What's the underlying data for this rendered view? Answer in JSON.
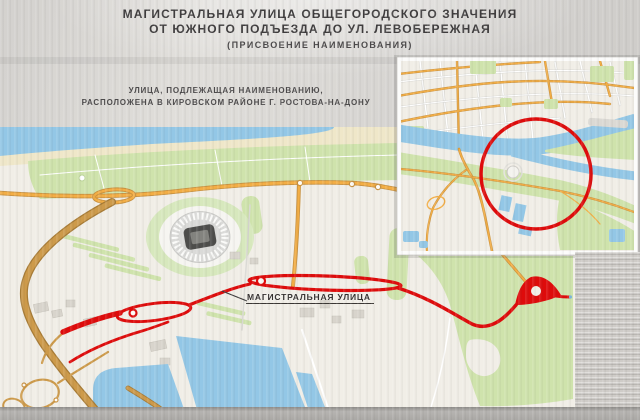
{
  "slide": {
    "title_line1": "МАГИСТРАЛЬНАЯ УЛИЦА ОБЩЕГОРОДСКОГО ЗНАЧЕНИЯ",
    "title_line2": "ОТ ЮЖНОГО ПОДЪЕЗДА ДО УЛ. ЛЕВОБЕРЕЖНАЯ",
    "title_line3": "(ПРИСВОЕНИЕ НАИМЕНОВАНИЯ)",
    "subtitle_line1": "УЛИЦА, ПОДЛЕЖАЩАЯ НАИМЕНОВАНИЮ,",
    "subtitle_line2": "РАСПОЛОЖЕНА В КИРОВСКОМ РАЙОНЕ Г. РОСТОВА-НА-ДОНУ"
  },
  "main_map": {
    "road_label": "МАГИСТРАЛЬНАЯ УЛИЦА"
  },
  "colors": {
    "page_bg": "#d7d5d2",
    "title_text": "#3e3c3d",
    "label_text": "#332f2e",
    "map_bg": "#f1eee7",
    "water_blue": "#93c7e6",
    "park_green": "#cfe3ac",
    "sand": "#efe7c9",
    "road_orange": "#f3ae45",
    "road_casing": "#c89140",
    "approach_road": "#cd9a4a",
    "approach_casing": "#a87c36",
    "highlight_red": "#de0b0b",
    "footer_bar": "#aaa8a5"
  }
}
